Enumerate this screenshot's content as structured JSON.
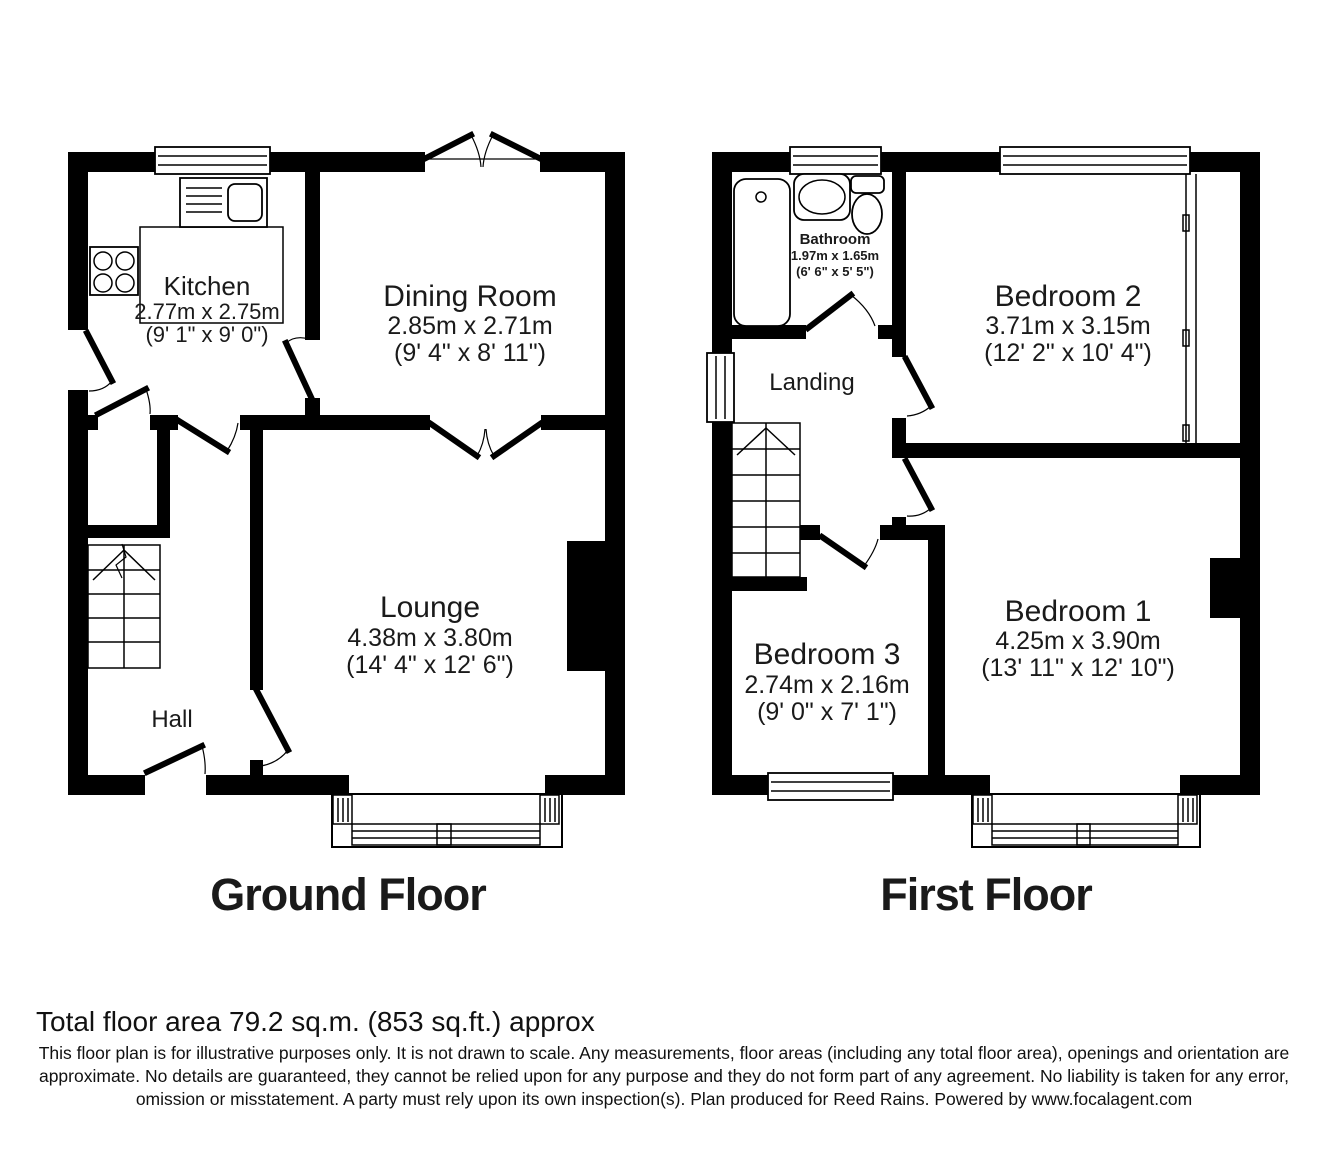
{
  "ground": {
    "title": "Ground Floor",
    "kitchen": {
      "name": "Kitchen",
      "metric": "2.77m x 2.75m",
      "imperial": "(9' 1\" x 9' 0\")"
    },
    "dining": {
      "name": "Dining Room",
      "metric": "2.85m x 2.71m",
      "imperial": "(9' 4\" x 8' 11\")"
    },
    "lounge": {
      "name": "Lounge",
      "metric": "4.38m x 3.80m",
      "imperial": "(14' 4\" x 12' 6\")"
    },
    "hall": {
      "name": "Hall"
    }
  },
  "first": {
    "title": "First Floor",
    "bathroom": {
      "name": "Bathroom",
      "metric": "1.97m x 1.65m",
      "imperial": "(6' 6\" x 5' 5\")"
    },
    "bedroom2": {
      "name": "Bedroom 2",
      "metric": "3.71m x 3.15m",
      "imperial": "(12' 2\" x 10' 4\")"
    },
    "landing": {
      "name": "Landing"
    },
    "bedroom3": {
      "name": "Bedroom 3",
      "metric": "2.74m x 2.16m",
      "imperial": "(9' 0\" x 7' 1\")"
    },
    "bedroom1": {
      "name": "Bedroom 1",
      "metric": "4.25m x 3.90m",
      "imperial": "(13' 11\" x 12' 10\")"
    }
  },
  "footer": {
    "total_area": "Total floor area 79.2 sq.m. (853 sq.ft.) approx",
    "disclaimer": "This floor plan is for illustrative purposes only. It is not drawn to scale. Any measurements, floor areas (including any total floor area), openings and orientation are approximate. No details are guaranteed, they cannot be relied upon for any purpose and they do not form part of any agreement. No liability is taken for any error, omission or misstatement. A party must rely upon its own inspection(s). Plan produced for Reed Rains. Powered by www.focalagent.com"
  },
  "colors": {
    "wall": "#000000",
    "background": "#ffffff"
  }
}
